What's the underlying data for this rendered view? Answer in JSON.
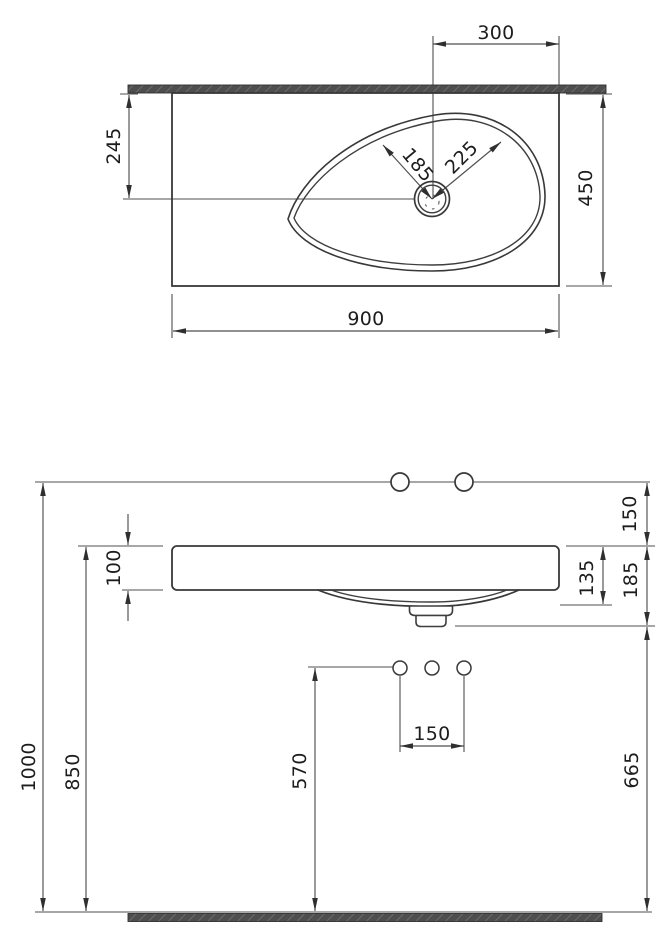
{
  "drawing": {
    "type": "washbasin technical dimension drawing",
    "colors": {
      "background": "#ffffff",
      "object_line": "#383838",
      "dimension_line": "#4f4f4f",
      "text": "#1d1d1d",
      "hatch_fill": "#4e4e4e",
      "hatch_stripe": "#6b6b6b"
    }
  },
  "plan_view": {
    "name": "plan view",
    "dims": {
      "drain_offset_from_right": "300",
      "drain_offset_from_wall": "245",
      "basin_reach_left": "185",
      "basin_reach_right": "225",
      "depth": "450",
      "width": "900"
    }
  },
  "front_view": {
    "name": "front elevation",
    "dims": {
      "tap_line_above_rim": "150",
      "slab_thickness": "100",
      "basin_depth": "135",
      "overall_body_depth": "185",
      "hole_spacing": "150",
      "supply_height": "570",
      "rim_height": "850",
      "tap_line_height": "1000",
      "outlet_height": "665"
    }
  }
}
